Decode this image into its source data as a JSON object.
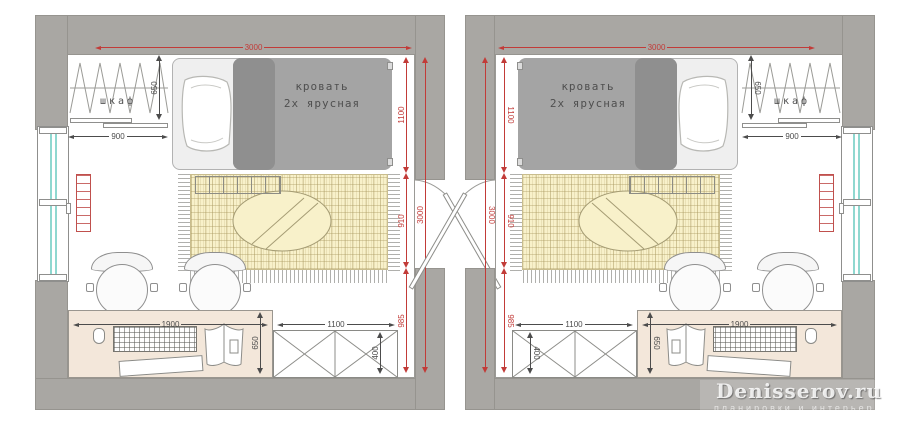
{
  "watermark": {
    "title": "Denisserov.ru",
    "subtitle": "планировки и интерьеры"
  },
  "room": {
    "labels": {
      "wardrobe": "шкаф",
      "bed_line1": "кровать",
      "bed_line2": "2х ярусная"
    },
    "dims": {
      "room_width": "3000",
      "room_depth": "3000",
      "zone_bed": "1100",
      "zone_middle": "910",
      "zone_desk": "985",
      "wardrobe_width": "900",
      "wardrobe_depth": "650",
      "desk_width": "1900",
      "desk_depth": "650",
      "cabinet_width": "1100",
      "cabinet_depth": "400"
    }
  },
  "colors": {
    "wall": "#a9a7a3",
    "dim_red": "#c23b38",
    "dim_dark": "#4c4c4c",
    "rug": "#f8f1ca",
    "desk": "#f3e7da",
    "window_glass": "#8fd8d0",
    "radiator": "#c0504d",
    "bed_upper": "#a4a4a4",
    "bed_upper_dark": "#8f8f8f",
    "bed_lower": "#efefef"
  }
}
